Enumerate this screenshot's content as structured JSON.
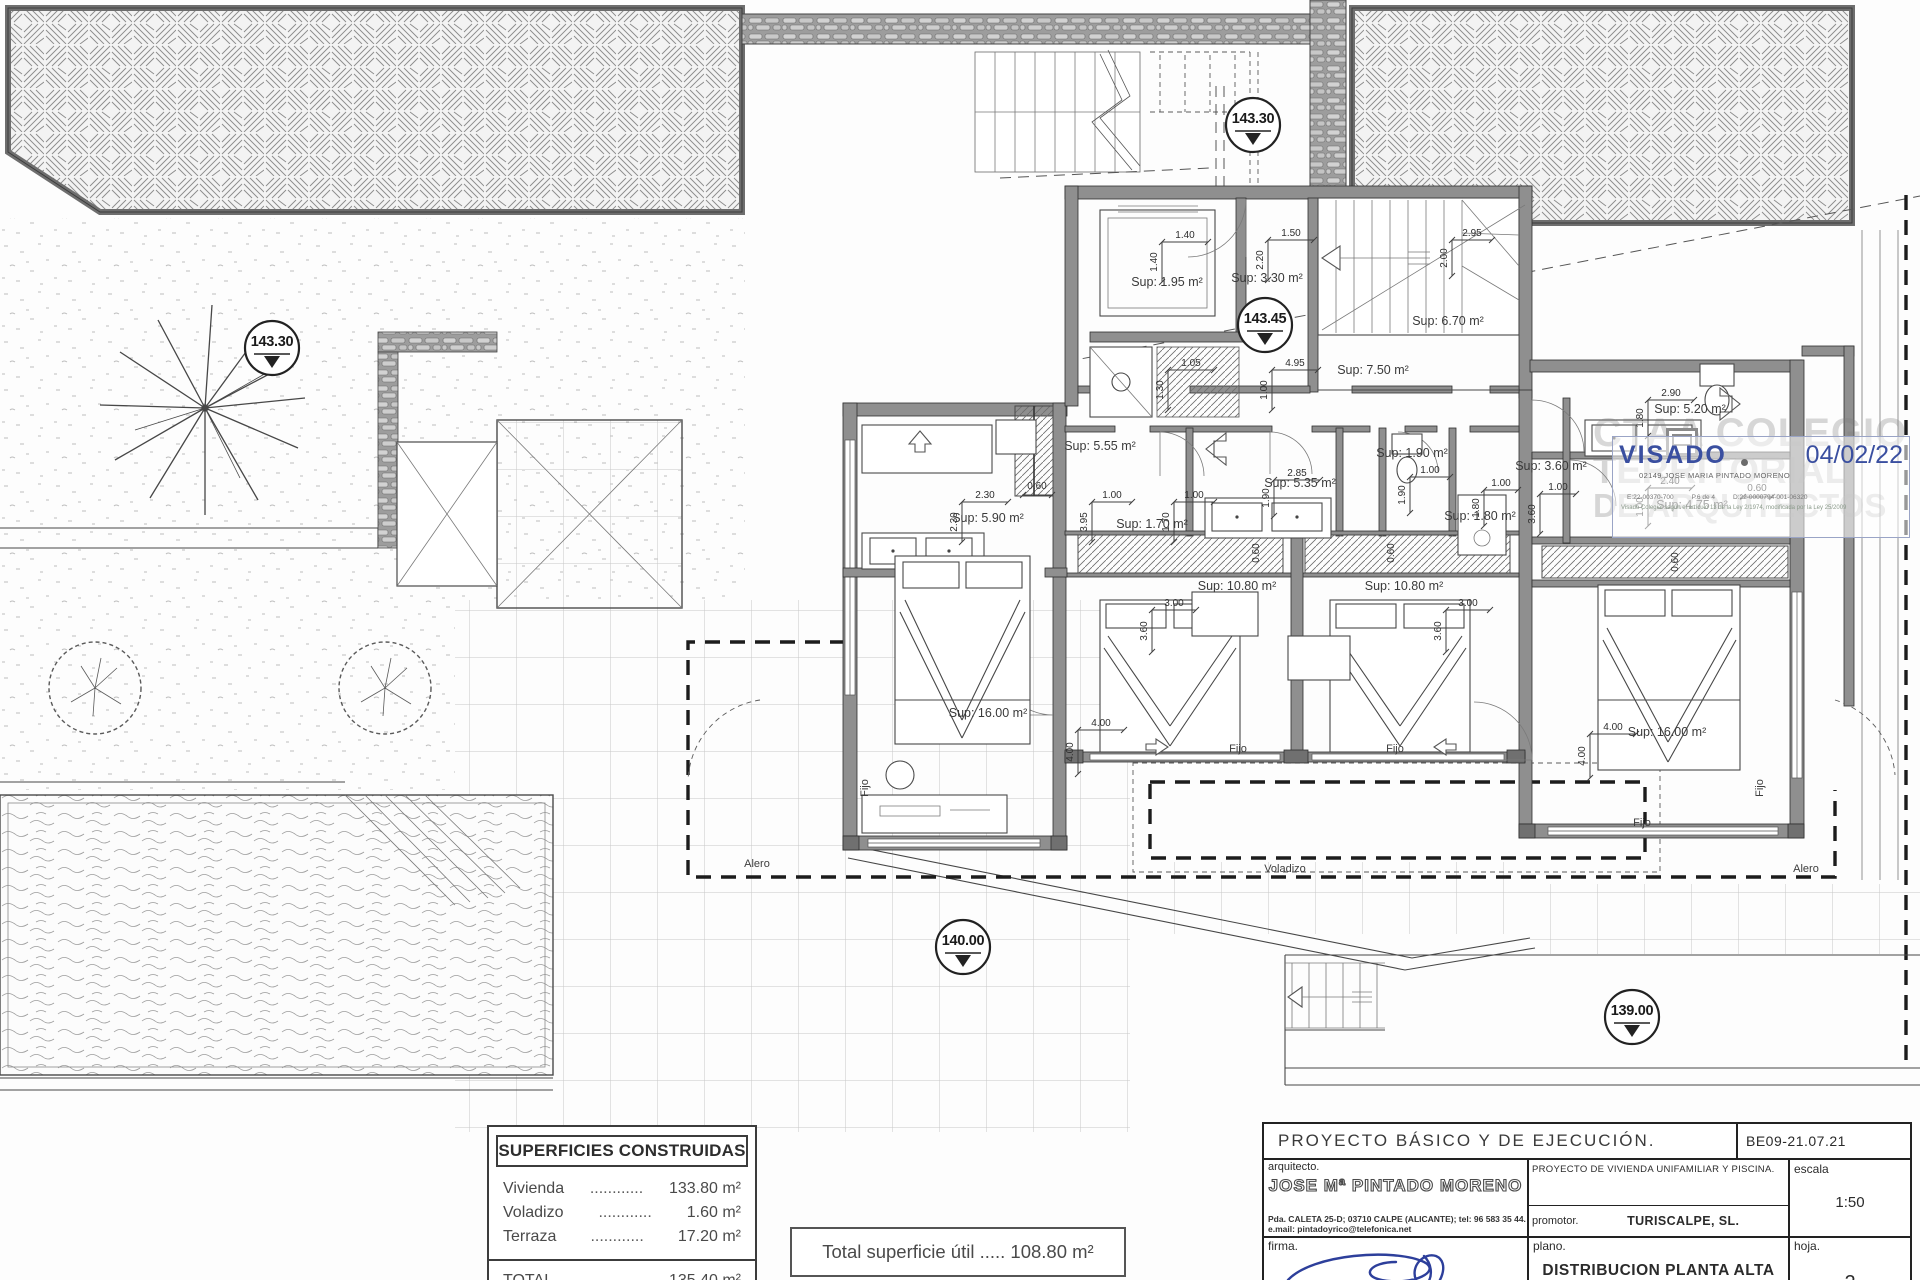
{
  "labels": {
    "rooms": [
      "Sup: 1.95 m²",
      "Sup: 3.30 m²",
      "Sup: 6.70 m²",
      "Sup: 7.50 m²",
      "Sup: 5.55 m²",
      "Sup: 5.90 m²",
      "Sup: 1.70 m²",
      "Sup: 5.35 m²",
      "Sup: 1.90 m²",
      "Sup: 1.80 m²",
      "Sup: 10.80 m²",
      "Sup: 10.80 m²",
      "Sup: 3.60 m²",
      "Sup: 5.20 m²",
      "Sup: 4.75 m²",
      "Sup: 16.00 m²",
      "Sup: 16.00 m²"
    ],
    "dims": [
      "1.40",
      "1.40",
      "1.50",
      "2.20",
      "2.95",
      "2.00",
      "1.05",
      "1.30",
      "4.95",
      "1.00",
      "2.30",
      "2.30",
      "0.60",
      "1.00",
      "3.95",
      "1.00",
      "1.70",
      "2.85",
      "1.90",
      "1.00",
      "1.90",
      "1.00",
      "1.80",
      "3.00",
      "3.60",
      "3.00",
      "3.60",
      "4.00",
      "4.00",
      "4.00",
      "4.00",
      "2.90",
      "1.80",
      "1.00",
      "3.60",
      "2.40",
      "1.00",
      "0.60",
      "0.60",
      "0.60",
      "0.60"
    ],
    "markers": [
      "143.30",
      "143.45",
      "143.30",
      "140.00",
      "139.00"
    ],
    "annotations": {
      "fijo": "Fijo",
      "voladizo": "Voladizo",
      "alero": "Alero"
    }
  },
  "surfaces_table": {
    "title": "SUPERFICIES CONSTRUIDAS",
    "rows": [
      {
        "label": "Vivienda",
        "dots": "............",
        "value": "133.80 m²"
      },
      {
        "label": "Voladizo",
        "dots": "............",
        "value": "1.60 m²"
      },
      {
        "label": "Terraza",
        "dots": "............",
        "value": "17.20 m²"
      }
    ],
    "total_label": "TOTAL",
    "total_dots": "............",
    "total_value": "135.40 m²"
  },
  "total_box": {
    "text": "Total superficie útil ..... 108.80 m²"
  },
  "title_block": {
    "project_title": "PROYECTO  BÁSICO  Y  DE  EJECUCIÓN.",
    "code": "BE09-21.07.21",
    "architect_label": "arquitecto.",
    "architect_name": "JOSE Mª PINTADO MORENO",
    "architect_address": "Pda.  CALETA  25-D;  03710  CALPE  (ALICANTE);  tel:  96 583 35 44.",
    "architect_email": "e.mail:  pintadoyrico@telefonica.net",
    "project_desc": "PROYECTO  DE  VIVIENDA  UNIFAMILIAR  Y  PISCINA.",
    "promoter_label": "promotor.",
    "promoter_name": "TURISCALPE,  SL.",
    "scale_label": "escala",
    "scale_value": "1:50",
    "signature_label": "firma.",
    "plan_label": "plano.",
    "plan_name": "DISTRIBUCION  PLANTA  ALTA",
    "sheet_label": "hoja.",
    "sheet_number": "2"
  },
  "stamp": {
    "visado_label": "VISADO",
    "visado_date": "04/02/22",
    "collegiate": "02149 JOSE MARIA PINTADO MORENO",
    "code_e": "E:22-00370-700",
    "code_p": "P.6 de 4",
    "code_d": "D:22-0000794-001-06320",
    "legal_note": "Visado Colegial según el artículo 13 de la Ley 2/1974, modificada por la Ley 25/2009",
    "watermark_line1": "CTAA COLEGIO",
    "watermark_line2": "TERRITORIAL",
    "watermark_line3": "DE ARQUITECTOS"
  }
}
